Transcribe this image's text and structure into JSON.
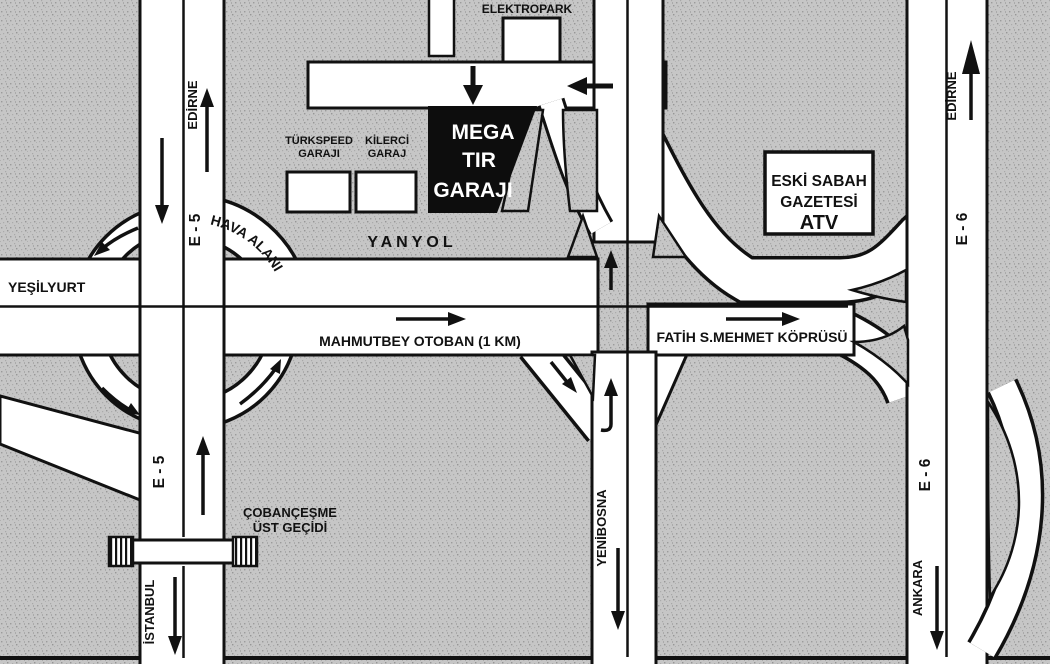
{
  "map": {
    "type": "hand-drawn road access map (scanned, Istanbul)",
    "destination": {
      "line1": "MEGA",
      "line2": "TIR",
      "line3": "GARAJI"
    },
    "buildings": {
      "elektropark": "ELEKTROPARK",
      "turkspeed_line1": "TÜRKSPEED",
      "turkspeed_line2": "GARAJI",
      "kilerci_line1": "KİLERCİ",
      "kilerci_line2": "GARAJ",
      "eski_line1": "ESKİ SABAH",
      "eski_line2": "GAZETESİ",
      "eski_line3": "ATV"
    },
    "roads": {
      "yanyol": "YANYOL",
      "hava_alani": "HAVA ALANI",
      "yesilyurt": "YEŞİLYURT",
      "mahmutbey": "MAHMUTBEY OTOBAN (1 KM)",
      "fatih": "FATİH S.MEHMET KÖPRÜSÜ",
      "yenibosna": "YENİBOSNA",
      "cobancesme_line1": "ÇOBANÇEŞME",
      "cobancesme_line2": "ÜST GEÇİDİ"
    },
    "route_labels": {
      "e5_upper": "E - 5",
      "e5_lower": "E - 5",
      "e6_upper": "E - 6",
      "e6_lower": "E - 6",
      "edirne_west": "EDİRNE",
      "istanbul": "İSTANBUL",
      "edirne_east": "EDİRNE",
      "ankara": "ANKARA"
    },
    "colors": {
      "background": "#c7c7c7",
      "road_fill": "#ffffff",
      "road_casing": "#111111",
      "destination_block": "#0d0d0d",
      "destination_text": "#ffffff"
    }
  }
}
